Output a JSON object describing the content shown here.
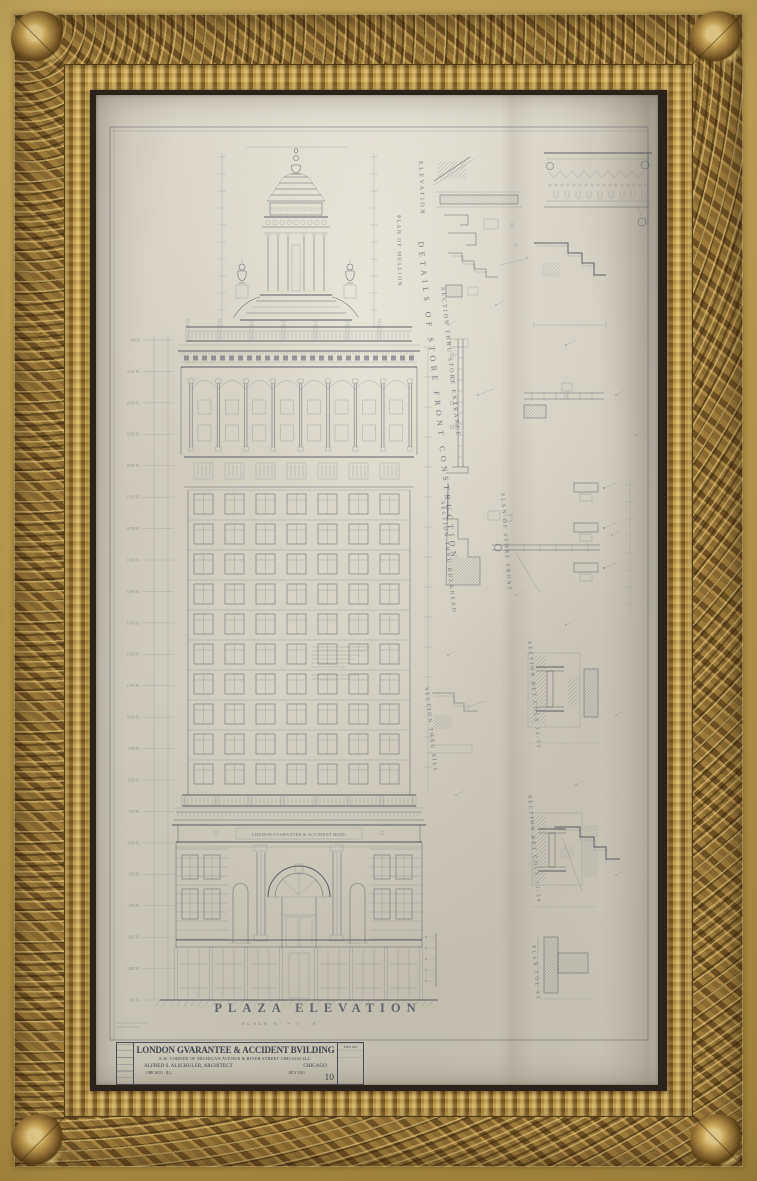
{
  "artwork": {
    "description": "Framed architectural elevation drawing in ornate gilded frame",
    "frame_gold": "#c9a455",
    "frame_bronze": "#82612d",
    "paper_color": "#cfcbbe",
    "ink_color": "#4e5462"
  },
  "sheet": {
    "title": "PLAZA ELEVATION",
    "scale_note": "SCALE ⅛˝ = 1´- 0˝",
    "frieze_inscription": "LONDON GVARANTEE & ACCIDENT BLDG"
  },
  "title_block": {
    "name_line": "LONDON GVARANTEE & ACCIDENT BVILDING",
    "address_line": "S.W. CORNER OF MICHIGAN AVENUE & RIVER STREET CHICAGO ILL.",
    "architect_line": "ALFRED S. ALSCHULER, ARCHITECT",
    "architect_city": "CHICAGO",
    "office_line": "CHICAGO · ILL.",
    "date_line": "JULY 1921",
    "sheet_number": "10",
    "file_box_label": "FILE NO"
  },
  "diagonal_labels": [
    "ELEVATION",
    "PLAN OF MULLION",
    "SECTION THRU STORE ENTRANCE",
    "DETAILS OF STORE FRONT CONSTRUCTION",
    "SECTION THRU BULKHEAD",
    "PLAN OF STORE FRONT",
    "SECTION THRU SILL",
    "SECTION BET COLS 34-35",
    "SECTION BET COLS 33-34",
    "PLAN COL 33"
  ],
  "levels": [
    "ROOF",
    "21ST FL",
    "20TH FL",
    "19TH FL",
    "18TH FL",
    "17TH FL",
    "16TH FL",
    "15TH FL",
    "14TH FL",
    "13TH FL",
    "12TH FL",
    "11TH FL",
    "10TH FL",
    "9TH FL",
    "8TH FL",
    "7TH FL",
    "6TH FL",
    "5TH FL",
    "4TH FL",
    "3RD FL",
    "2ND FL",
    "1ST FL"
  ]
}
